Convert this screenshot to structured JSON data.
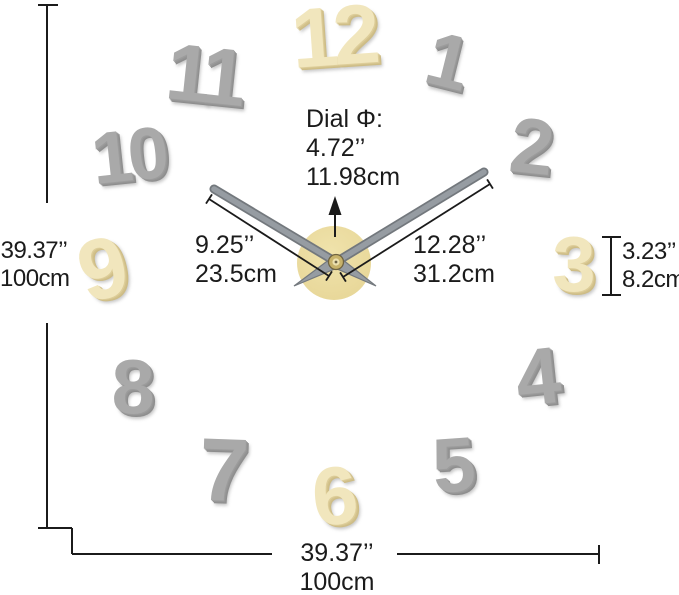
{
  "image": {
    "type": "product-dimension-diagram",
    "subject": "Frameless DIY 3D wall clock with stick-on numerals"
  },
  "colors": {
    "text": "#1b1b1b",
    "line": "#1b1b1b",
    "gray_number": "#a9a9a9",
    "gray_number_shade": "#8e8e8e",
    "gold_number": "#f1e6bd",
    "gold_number_shade": "#cdbc85",
    "dial_gold": "#e7d697",
    "dial_gold_light": "#f0e3ac",
    "hand_gray": "#969ca2",
    "hand_edge": "#73787d",
    "background": "#ffffff"
  },
  "clock": {
    "numbers": [
      {
        "value": "12",
        "finish": "gold"
      },
      {
        "value": "1",
        "finish": "gray"
      },
      {
        "value": "2",
        "finish": "gray"
      },
      {
        "value": "3",
        "finish": "gold"
      },
      {
        "value": "4",
        "finish": "gray"
      },
      {
        "value": "5",
        "finish": "gray"
      },
      {
        "value": "6",
        "finish": "gold"
      },
      {
        "value": "7",
        "finish": "gray"
      },
      {
        "value": "8",
        "finish": "gray"
      },
      {
        "value": "9",
        "finish": "gold"
      },
      {
        "value": "10",
        "finish": "gray"
      },
      {
        "value": "11",
        "finish": "gray"
      }
    ]
  },
  "annotations": {
    "wall_height": {
      "inches": "39.37’’",
      "cm": "100cm"
    },
    "wall_width": {
      "inches": "39.37’’",
      "cm": "100cm"
    },
    "numeral_height": {
      "inches": "3.23’’",
      "cm": "8.2cm"
    },
    "dial": {
      "label": "Dial Φ:",
      "inches": "4.72’’",
      "cm": "11.98cm"
    },
    "hour_hand": {
      "inches": "9.25’’",
      "cm": "23.5cm"
    },
    "minute_hand": {
      "inches": "12.28’’",
      "cm": "31.2cm"
    }
  }
}
